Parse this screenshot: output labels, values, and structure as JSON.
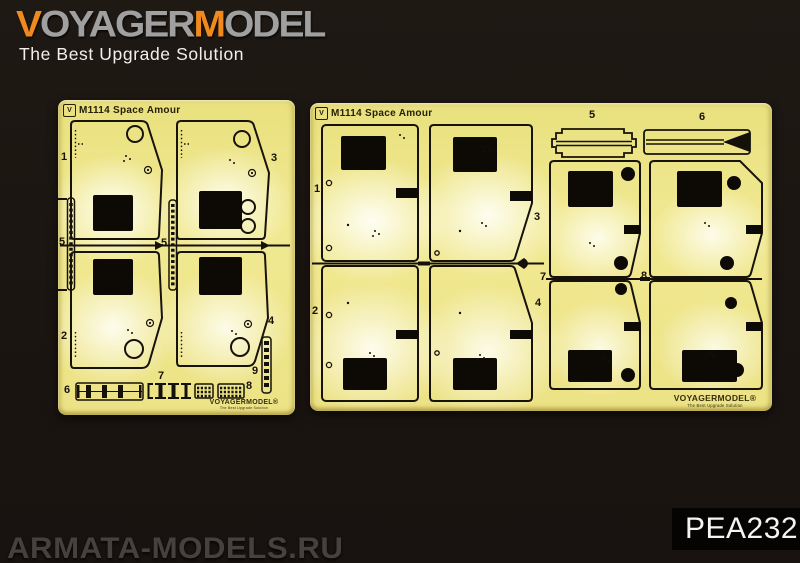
{
  "brand": {
    "seg1": "V",
    "seg2": "OYAGER",
    "seg3": "M",
    "seg4": "ODEL",
    "tagline": "The Best Upgrade Solution"
  },
  "product_code": "PEA232",
  "site_watermark": "ARMATA-MODELS.RU",
  "fret_left": {
    "logo_mark": "V",
    "title": "M1114  Space Amour",
    "labels": {
      "p1": "1",
      "p3": "3",
      "p5a": "5",
      "p5b": "5",
      "p2": "2",
      "p4": "4",
      "p6": "6",
      "p7": "7",
      "p8": "8",
      "p9": "9"
    },
    "brand_etch": "VOYAGERMODEL®",
    "brand_etch_tagline": "The Best Upgrade Solution"
  },
  "fret_right": {
    "logo_mark": "V",
    "title": "M1114  Space Amour",
    "labels": {
      "p5": "5",
      "p6": "6",
      "p1": "1",
      "p3": "3",
      "p7": "7",
      "p8": "8",
      "p2": "2",
      "p4": "4"
    },
    "brand_etch": "VOYAGERMODEL®",
    "brand_etch_tagline": "The Best Upgrade Solution"
  },
  "colors": {
    "accent_orange": "#f08a1e",
    "logo_gray": "#a0a0a0",
    "brass": "#f0e88f",
    "background": "#1b1511",
    "code_text": "#f4f4f2"
  }
}
